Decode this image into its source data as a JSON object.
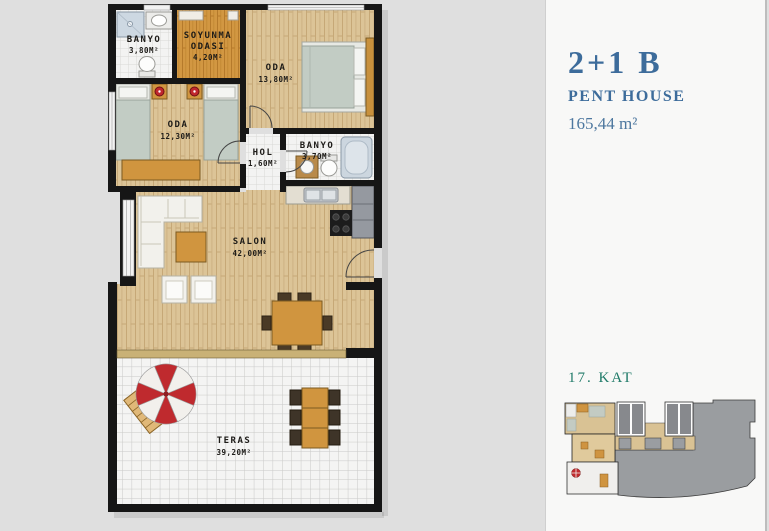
{
  "panel": {
    "title": "2+1 B",
    "subtitle": "PENT HOUSE",
    "area": "165,44 m²",
    "floor_label": "17. KAT"
  },
  "plan": {
    "rooms": {
      "banyo_top": {
        "name": "BANYO",
        "area": "3,80M²"
      },
      "soyunma": {
        "name": "SOYUNMA",
        "name2": "ODASI",
        "area": "4,20M²"
      },
      "oda_big": {
        "name": "ODA",
        "area": "13,80M²"
      },
      "oda_small": {
        "name": "ODA",
        "area": "12,30M²"
      },
      "hol": {
        "name": "HOL",
        "area": "1,60M²"
      },
      "banyo_mid": {
        "name": "BANYO",
        "area": "3,70M²"
      },
      "salon": {
        "name": "SALON",
        "area": "42,00M²"
      },
      "teras": {
        "name": "TERAS",
        "area": "39,20M²"
      }
    }
  },
  "colors": {
    "accent_blue": "#3d6c9b",
    "floor_teal": "#1f7a68",
    "wall_black": "#161616",
    "wood_floor": "#dcc497",
    "dressing_wood": "#d29742",
    "umbrella_red": "#bf2a2e",
    "background": "#dfdfdf",
    "panel_background": "#f8f8f7"
  }
}
